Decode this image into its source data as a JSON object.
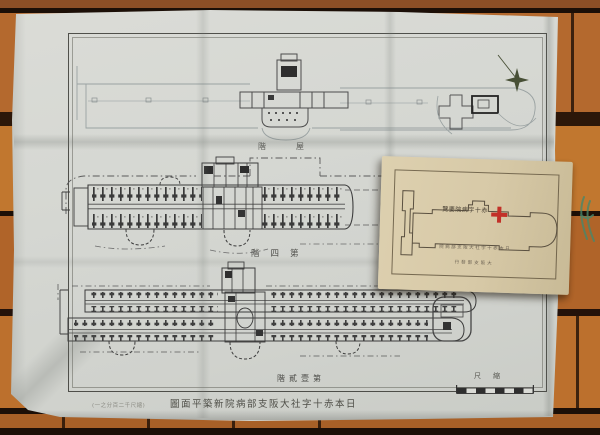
{
  "map_sheet": {
    "floor_labels": {
      "roof": "階屋",
      "fourth_floor": "階四第",
      "first_second_floor": "階貳壹第"
    },
    "scale": {
      "label": "尺縮"
    },
    "caption": {
      "note": "(一之分百二千尺縮)",
      "title": "圖面平築新院病部支阪大社字十赤本日"
    },
    "colors": {
      "paper": "#d6d7d2",
      "ink": "#3c3c3c",
      "faint_ink": "#9aa2a2"
    }
  },
  "booklet_card": {
    "title": "覽要院病字十赤",
    "subtitle": "院病部支阪大社字十赤本日",
    "imprint": "行發部支阪大",
    "colors": {
      "paper": "#d7caa8",
      "cross": "#c23128"
    }
  },
  "scene": {
    "background": "wood-table",
    "colors": {
      "wood_light": "#c1772f",
      "wood_dark": "#1c0f07"
    }
  }
}
